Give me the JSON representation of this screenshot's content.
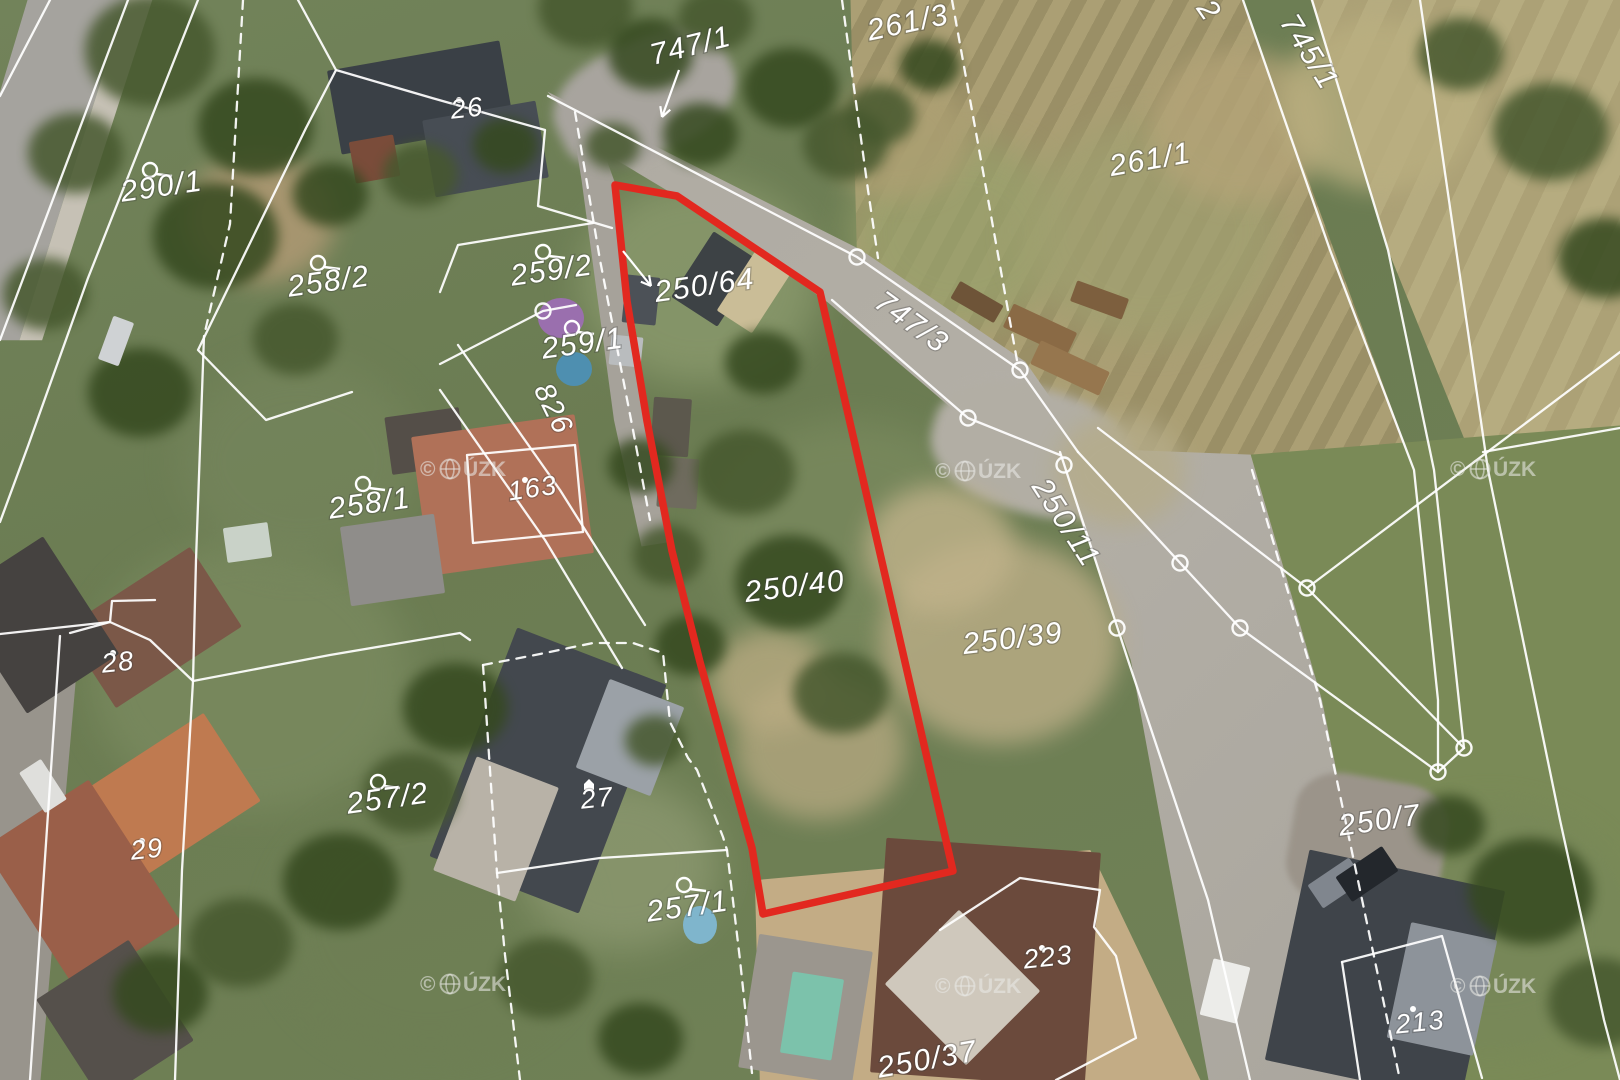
{
  "map": {
    "credit": "© ČÚZK",
    "colors": {
      "boundary": "#ffffff",
      "highlight": "#e2281f",
      "label": "#ffffff",
      "watermark": "rgba(232,232,230,0.58)"
    },
    "highlight_parcel": {
      "numbers": [
        "250/64",
        "250/40"
      ],
      "outline": [
        [
          615,
          185
        ],
        [
          677,
          196
        ],
        [
          820,
          292
        ],
        [
          953,
          871
        ],
        [
          763,
          914
        ],
        [
          752,
          848
        ],
        [
          733,
          781
        ],
        [
          700,
          662
        ],
        [
          672,
          551
        ],
        [
          647,
          421
        ],
        [
          627,
          301
        ]
      ]
    },
    "labels": [
      {
        "text": "747/1",
        "x": 693,
        "y": 55,
        "rot": -14,
        "size": 30
      },
      {
        "text": "261/3",
        "x": 910,
        "y": 32,
        "rot": -12,
        "size": 30
      },
      {
        "text": "2",
        "x": 1201,
        "y": 16,
        "rot": 55,
        "size": 30
      },
      {
        "text": "745/1",
        "x": 1301,
        "y": 57,
        "rot": 58,
        "size": 30
      },
      {
        "text": "261/1",
        "x": 1152,
        "y": 169,
        "rot": -10,
        "size": 30
      },
      {
        "text": "290/1",
        "x": 163,
        "y": 196,
        "rot": -8,
        "size": 30,
        "symbol": "circle",
        "sx": 150,
        "sy": 170
      },
      {
        "text": "26",
        "x": 468,
        "y": 117,
        "rot": -6,
        "size": 27,
        "symbol": "dot",
        "sx": 459,
        "sy": 100
      },
      {
        "text": "258/2",
        "x": 330,
        "y": 291,
        "rot": -8,
        "size": 30,
        "symbol": "circle",
        "sx": 318,
        "sy": 263
      },
      {
        "text": "259/2",
        "x": 553,
        "y": 280,
        "rot": -8,
        "size": 30,
        "symbol": "circle",
        "sx": 543,
        "sy": 252
      },
      {
        "text": "259/1",
        "x": 584,
        "y": 353,
        "rot": -8,
        "size": 30,
        "symbol": "circle",
        "sx": 572,
        "sy": 328
      },
      {
        "text": "826",
        "x": 545,
        "y": 413,
        "rot": 64,
        "size": 29
      },
      {
        "text": "250/64",
        "x": 706,
        "y": 295,
        "rot": -8,
        "size": 30
      },
      {
        "text": "747/3",
        "x": 906,
        "y": 330,
        "rot": 36,
        "size": 30
      },
      {
        "text": "250/11",
        "x": 1058,
        "y": 528,
        "rot": 57,
        "size": 30
      },
      {
        "text": "163",
        "x": 534,
        "y": 497,
        "rot": -8,
        "size": 27,
        "symbol": "dot",
        "sx": 525,
        "sy": 480
      },
      {
        "text": "258/1",
        "x": 371,
        "y": 513,
        "rot": -8,
        "size": 30,
        "symbol": "circle",
        "sx": 363,
        "sy": 484
      },
      {
        "text": "250/40",
        "x": 796,
        "y": 596,
        "rot": -7,
        "size": 30
      },
      {
        "text": "250/39",
        "x": 1014,
        "y": 648,
        "rot": -7,
        "size": 30
      },
      {
        "text": "28",
        "x": 119,
        "y": 671,
        "rot": -6,
        "size": 27,
        "symbol": "dot",
        "sx": 113,
        "sy": 653
      },
      {
        "text": "257/2",
        "x": 389,
        "y": 808,
        "rot": -8,
        "size": 30,
        "symbol": "circle",
        "sx": 378,
        "sy": 782
      },
      {
        "text": "29",
        "x": 148,
        "y": 858,
        "rot": -6,
        "size": 27,
        "symbol": "dot",
        "sx": 142,
        "sy": 841
      },
      {
        "text": "27",
        "x": 598,
        "y": 807,
        "rot": -6,
        "size": 27,
        "symbol": "house",
        "sx": 589,
        "sy": 786
      },
      {
        "text": "257/1",
        "x": 689,
        "y": 916,
        "rot": -8,
        "size": 30,
        "symbol": "circle",
        "sx": 684,
        "sy": 885
      },
      {
        "text": "250/7",
        "x": 1381,
        "y": 830,
        "rot": -8,
        "size": 30
      },
      {
        "text": "223",
        "x": 1049,
        "y": 966,
        "rot": -6,
        "size": 27,
        "symbol": "dot",
        "sx": 1042,
        "sy": 948
      },
      {
        "text": "213",
        "x": 1421,
        "y": 1031,
        "rot": -6,
        "size": 27,
        "symbol": "dot",
        "sx": 1413,
        "sy": 1009
      },
      {
        "text": "250/37",
        "x": 929,
        "y": 1069,
        "rot": -10,
        "size": 30
      }
    ],
    "arrows": [
      {
        "from": [
          679,
          70
        ],
        "to": [
          662,
          117
        ]
      },
      {
        "from": [
          623,
          251
        ],
        "to": [
          651,
          286
        ]
      }
    ],
    "lines": [
      {
        "points": [
          [
            50,
            0
          ],
          [
            0,
            96
          ]
        ]
      },
      {
        "points": [
          [
            128,
            0
          ],
          [
            0,
            340
          ]
        ]
      },
      {
        "points": [
          [
            198,
            0
          ],
          [
            88,
            278
          ],
          [
            28,
            446
          ],
          [
            0,
            522
          ]
        ]
      },
      {
        "points": [
          [
            243,
            0
          ],
          [
            230,
            224
          ],
          [
            204,
            336
          ]
        ],
        "dashed": true
      },
      {
        "points": [
          [
            204,
            336
          ],
          [
            196,
            560
          ],
          [
            193,
            681
          ]
        ]
      },
      {
        "points": [
          [
            298,
            0
          ],
          [
            336,
            70
          ],
          [
            306,
            128
          ],
          [
            198,
            350
          ],
          [
            266,
            420
          ],
          [
            352,
            392
          ]
        ]
      },
      {
        "points": [
          [
            336,
            70
          ],
          [
            432,
            98
          ],
          [
            545,
            130
          ],
          [
            538,
            206
          ],
          [
            612,
            228
          ]
        ]
      },
      {
        "points": [
          [
            440,
            292
          ],
          [
            458,
            245
          ],
          [
            593,
            223
          ]
        ]
      },
      {
        "points": [
          [
            440,
            364
          ],
          [
            543,
            311
          ],
          [
            576,
            305
          ]
        ]
      },
      {
        "points": [
          [
            458,
            345
          ],
          [
            560,
            490
          ],
          [
            645,
            625
          ]
        ]
      },
      {
        "points": [
          [
            440,
            390
          ],
          [
            545,
            540
          ],
          [
            622,
            668
          ]
        ]
      },
      {
        "points": [
          [
            548,
            96
          ],
          [
            857,
            257
          ],
          [
            1020,
            370
          ],
          [
            1078,
            452
          ]
        ]
      },
      {
        "points": [
          [
            832,
            300
          ],
          [
            968,
            418
          ],
          [
            1060,
            455
          ]
        ]
      },
      {
        "points": [
          [
            842,
            0
          ],
          [
            868,
            190
          ],
          [
            878,
            258
          ]
        ],
        "dashed": true
      },
      {
        "points": [
          [
            952,
            0
          ],
          [
            990,
            210
          ],
          [
            1018,
            366
          ]
        ],
        "dashed": true
      },
      {
        "points": [
          [
            1078,
            452
          ],
          [
            1240,
            628
          ],
          [
            1438,
            772
          ]
        ]
      },
      {
        "points": [
          [
            1098,
            428
          ],
          [
            1307,
            588
          ],
          [
            1464,
            748
          ]
        ]
      },
      {
        "points": [
          [
            1438,
            772
          ],
          [
            1464,
            748
          ]
        ]
      },
      {
        "points": [
          [
            1307,
            588
          ],
          [
            1620,
            352
          ]
        ]
      },
      {
        "points": [
          [
            1060,
            452
          ],
          [
            1128,
            660
          ],
          [
            1208,
            900
          ],
          [
            1250,
            1080
          ]
        ]
      },
      {
        "points": [
          [
            1252,
            470
          ],
          [
            1320,
            700
          ],
          [
            1400,
            1080
          ]
        ],
        "dashed": true
      },
      {
        "points": [
          [
            1243,
            0
          ],
          [
            1330,
            250
          ],
          [
            1414,
            470
          ],
          [
            1438,
            700
          ],
          [
            1438,
            772
          ]
        ]
      },
      {
        "points": [
          [
            1312,
            0
          ],
          [
            1388,
            250
          ],
          [
            1434,
            470
          ],
          [
            1464,
            748
          ]
        ]
      },
      {
        "points": [
          [
            1420,
            0
          ],
          [
            1488,
            470
          ],
          [
            1560,
            820
          ],
          [
            1604,
            1020
          ],
          [
            1620,
            1080
          ]
        ]
      },
      {
        "points": [
          [
            1483,
            452
          ],
          [
            1620,
            428
          ]
        ]
      },
      {
        "points": [
          [
            0,
            634
          ],
          [
            110,
            622
          ],
          [
            150,
            640
          ],
          [
            193,
            681
          ],
          [
            330,
            655
          ],
          [
            460,
            633
          ],
          [
            470,
            640
          ]
        ]
      },
      {
        "points": [
          [
            193,
            681
          ],
          [
            182,
            870
          ],
          [
            175,
            1080
          ]
        ]
      },
      {
        "points": [
          [
            70,
            633
          ],
          [
            110,
            622
          ],
          [
            112,
            601
          ],
          [
            155,
            600
          ]
        ]
      },
      {
        "points": [
          [
            483,
            665
          ],
          [
            535,
            655
          ],
          [
            593,
            643
          ],
          [
            633,
            643
          ],
          [
            663,
            653
          ],
          [
            670,
            722
          ],
          [
            688,
            758
          ],
          [
            697,
            770
          ],
          [
            723,
            837
          ],
          [
            727,
            850
          ],
          [
            740,
            960
          ],
          [
            752,
            1073
          ]
        ],
        "dashed": true
      },
      {
        "points": [
          [
            483,
            665
          ],
          [
            492,
            800
          ],
          [
            497,
            873
          ],
          [
            505,
            955
          ],
          [
            520,
            1080
          ]
        ],
        "dashed": true
      },
      {
        "points": [
          [
            497,
            873
          ],
          [
            600,
            858
          ],
          [
            727,
            850
          ]
        ]
      },
      {
        "points": [
          [
            467,
            455
          ],
          [
            575,
            445
          ],
          [
            583,
            532
          ],
          [
            473,
            543
          ],
          [
            467,
            455
          ]
        ]
      },
      {
        "points": [
          [
            940,
            930
          ],
          [
            1020,
            878
          ],
          [
            1100,
            890
          ],
          [
            1094,
            927
          ],
          [
            1116,
            956
          ],
          [
            1136,
            1038
          ],
          [
            1056,
            1080
          ]
        ]
      },
      {
        "points": [
          [
            1342,
            962
          ],
          [
            1442,
            936
          ],
          [
            1482,
            1078
          ]
        ]
      },
      {
        "points": [
          [
            1342,
            962
          ],
          [
            1360,
            1080
          ]
        ]
      },
      {
        "points": [
          [
            575,
            112
          ],
          [
            600,
            260
          ],
          [
            633,
            430
          ],
          [
            650,
            520
          ]
        ],
        "dashed": true
      },
      {
        "points": [
          [
            60,
            636
          ],
          [
            30,
            1080
          ]
        ]
      }
    ],
    "vertex_circles": [
      [
        857,
        257
      ],
      [
        1020,
        370
      ],
      [
        968,
        418
      ],
      [
        1064,
        465
      ],
      [
        1117,
        628
      ],
      [
        1180,
        563
      ],
      [
        1240,
        628
      ],
      [
        1307,
        588
      ],
      [
        1438,
        772
      ],
      [
        1464,
        748
      ],
      [
        543,
        311
      ]
    ],
    "watermarks": [
      [
        420,
        476
      ],
      [
        935,
        478
      ],
      [
        1450,
        476
      ],
      [
        420,
        991
      ],
      [
        935,
        993
      ],
      [
        1450,
        993
      ]
    ]
  }
}
